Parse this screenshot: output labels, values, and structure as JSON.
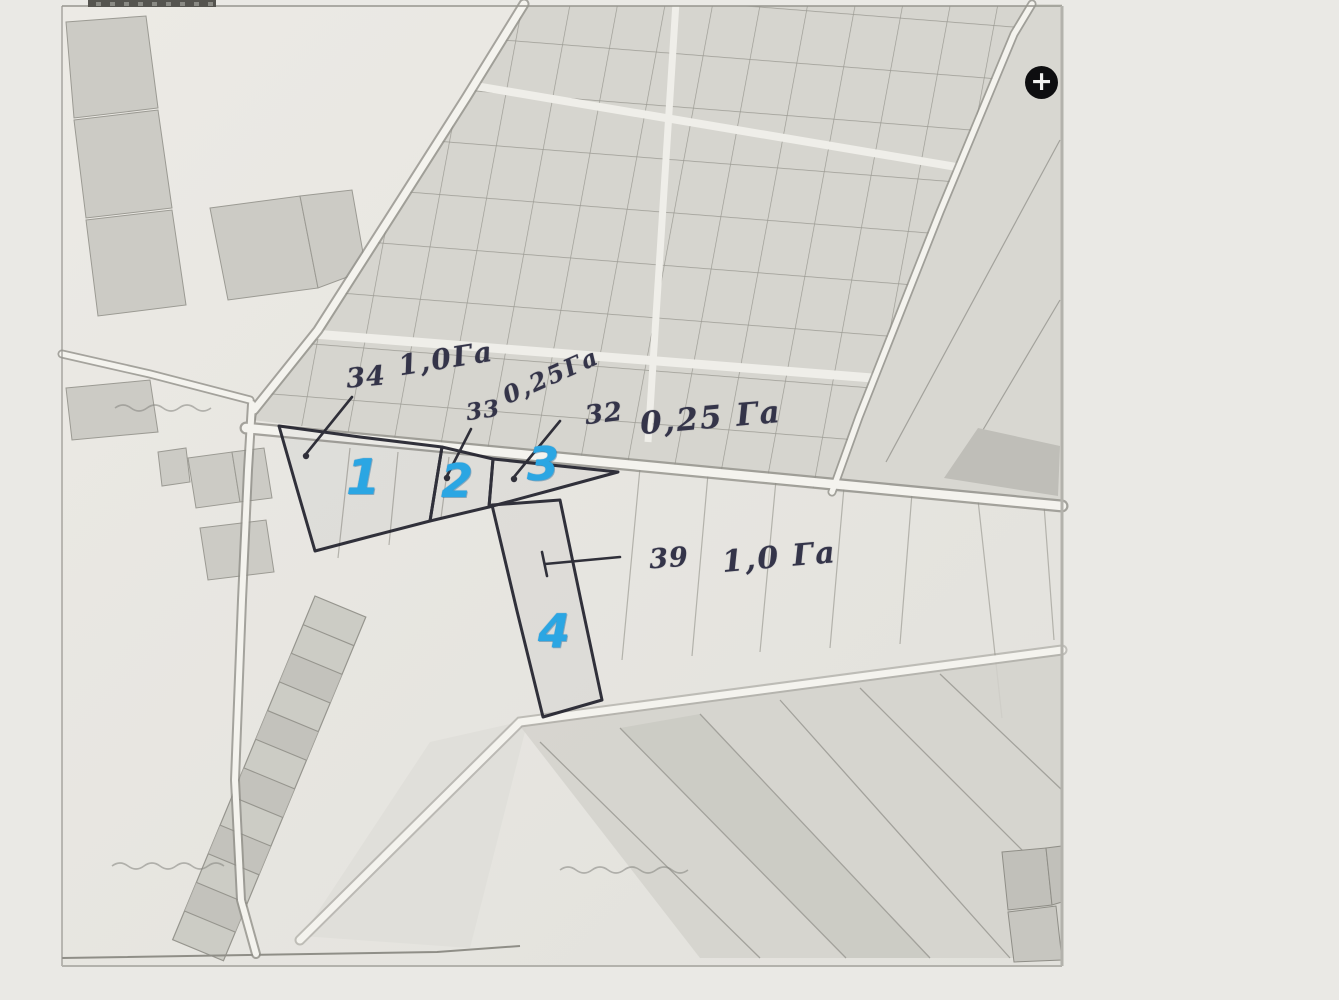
{
  "viewer": {
    "zoom_in_label": "+"
  },
  "annotations": {
    "a34": {
      "ref": "34",
      "area": "1,0Га"
    },
    "a33": {
      "ref": "33",
      "area": "0,25Га"
    },
    "a32": {
      "ref": "32",
      "area": "0,25 Га"
    },
    "a39": {
      "ref": "39",
      "area": "1,0 Га"
    }
  },
  "plot_numbers": {
    "p1": "1",
    "p2": "2",
    "p3": "3",
    "p4": "4"
  },
  "colors": {
    "highlight_blue": "#2ba6e3",
    "ink": "#343449",
    "pen": "#23232e",
    "paper": "#e7e6e1",
    "background": "#eae9e5"
  }
}
